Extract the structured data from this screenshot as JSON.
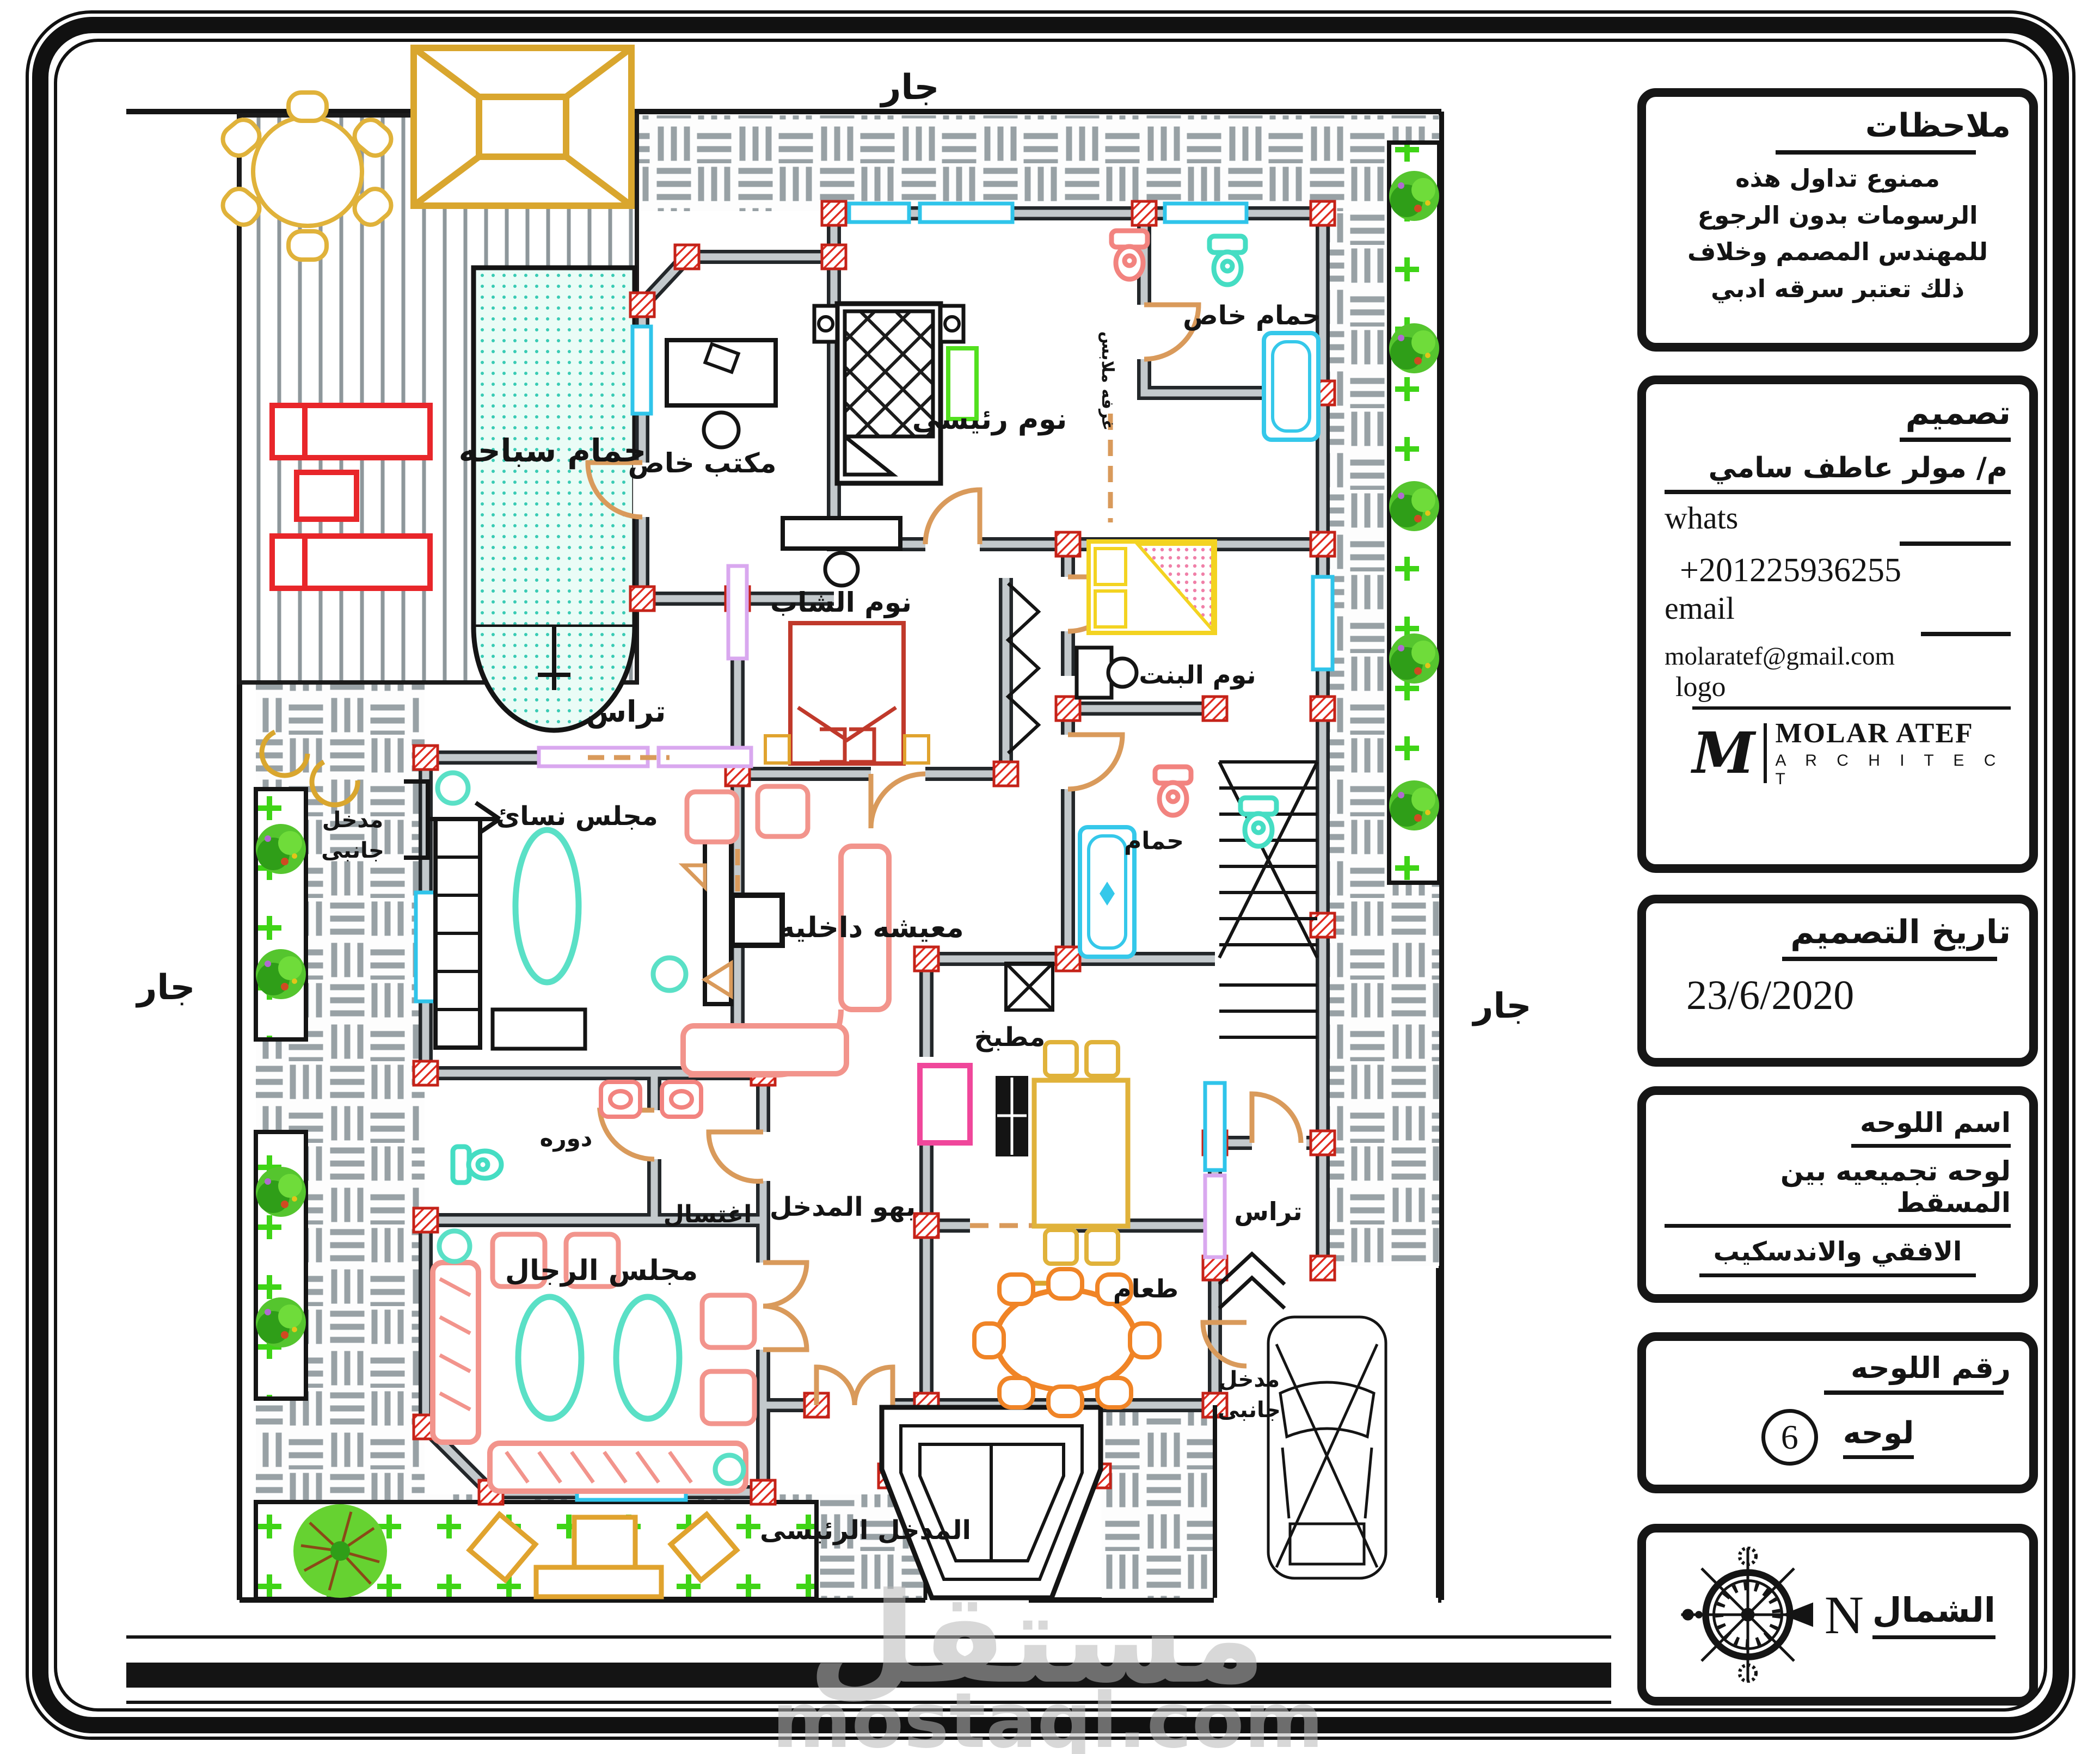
{
  "site": {
    "neighbor_top": "جار",
    "neighbor_left": "جار",
    "neighbor_right": "جار"
  },
  "rooms": {
    "pool": "حمام سباحه",
    "office": "مكتب خاص",
    "master_bedroom": "نوم رئيسى",
    "private_bath": "حمام خاص",
    "dressing_room": "غرفه ملابس",
    "boys_bedroom": "نوم الشاب",
    "girls_bedroom": "نوم البنت",
    "bathroom": "حمام",
    "terrace": "تراس",
    "terrace_right": "تراس",
    "women_majlis": "مجلس نسائ",
    "inner_living": "معيشه داخليه",
    "kitchen": "مطبخ",
    "wc": "دوره",
    "washing": "اغتسال",
    "entrance_hall": "بهو المدخل",
    "men_majlis": "مجلس الرجال",
    "dining": "طعام",
    "side_entrance_l1": "مدخل",
    "side_entrance_l2": "جانبى",
    "side_entrance_r1": "مدخل",
    "side_entrance_r2": "جانبى",
    "main_entrance": "المدخل الرئيسى"
  },
  "title_block": {
    "notes": {
      "title": "ملاحظات",
      "line1": "ممنوع تداول هذه",
      "line2": "الرسومات بدون الرجوع",
      "line3": "للمهندس المصمم وخلاف",
      "line4": "ذلك تعتبر سرقه ادبي"
    },
    "design": {
      "title": "تصميم",
      "designer": "م/ مولر عاطف سامي",
      "whats_label": "whats",
      "phone": "+201225936255",
      "email_label": "email",
      "email_value": "molaratef@gmail.com",
      "logo_label": "logo",
      "logo_mark": "M",
      "logo_name": "MOLAR ATEF",
      "logo_subtitle": "A R C H I T E C T"
    },
    "date": {
      "title": "تاريخ التصميم",
      "value": "23/6/2020"
    },
    "sheet_name": {
      "title": "اسم اللوحه",
      "line1": "لوحه تجميعيه بين المسقط",
      "line2": "الافقي والاندسكيب"
    },
    "sheet_number": {
      "title": "رقم اللوحه",
      "label": "لوحه",
      "value": "6"
    },
    "north": {
      "label": "الشمال",
      "letter": "N"
    }
  },
  "watermark": {
    "arabic": "مستقل",
    "latin": "mostaql.com"
  },
  "colors": {
    "wall_core": "#c3c9cc",
    "wall_edge": "#23272a",
    "column_red": "#e02b20",
    "door_tan": "#d99a5b",
    "window_cyan": "#2fc4ea",
    "window_purple": "#d9a8ef",
    "pool_teal": "#39cbb4",
    "sofa_pink": "#f2948c",
    "accent_yellow": "#d9a62e",
    "dining_orange": "#f08426",
    "garden_green": "#3fd416",
    "counter_pink": "#f0479b"
  }
}
